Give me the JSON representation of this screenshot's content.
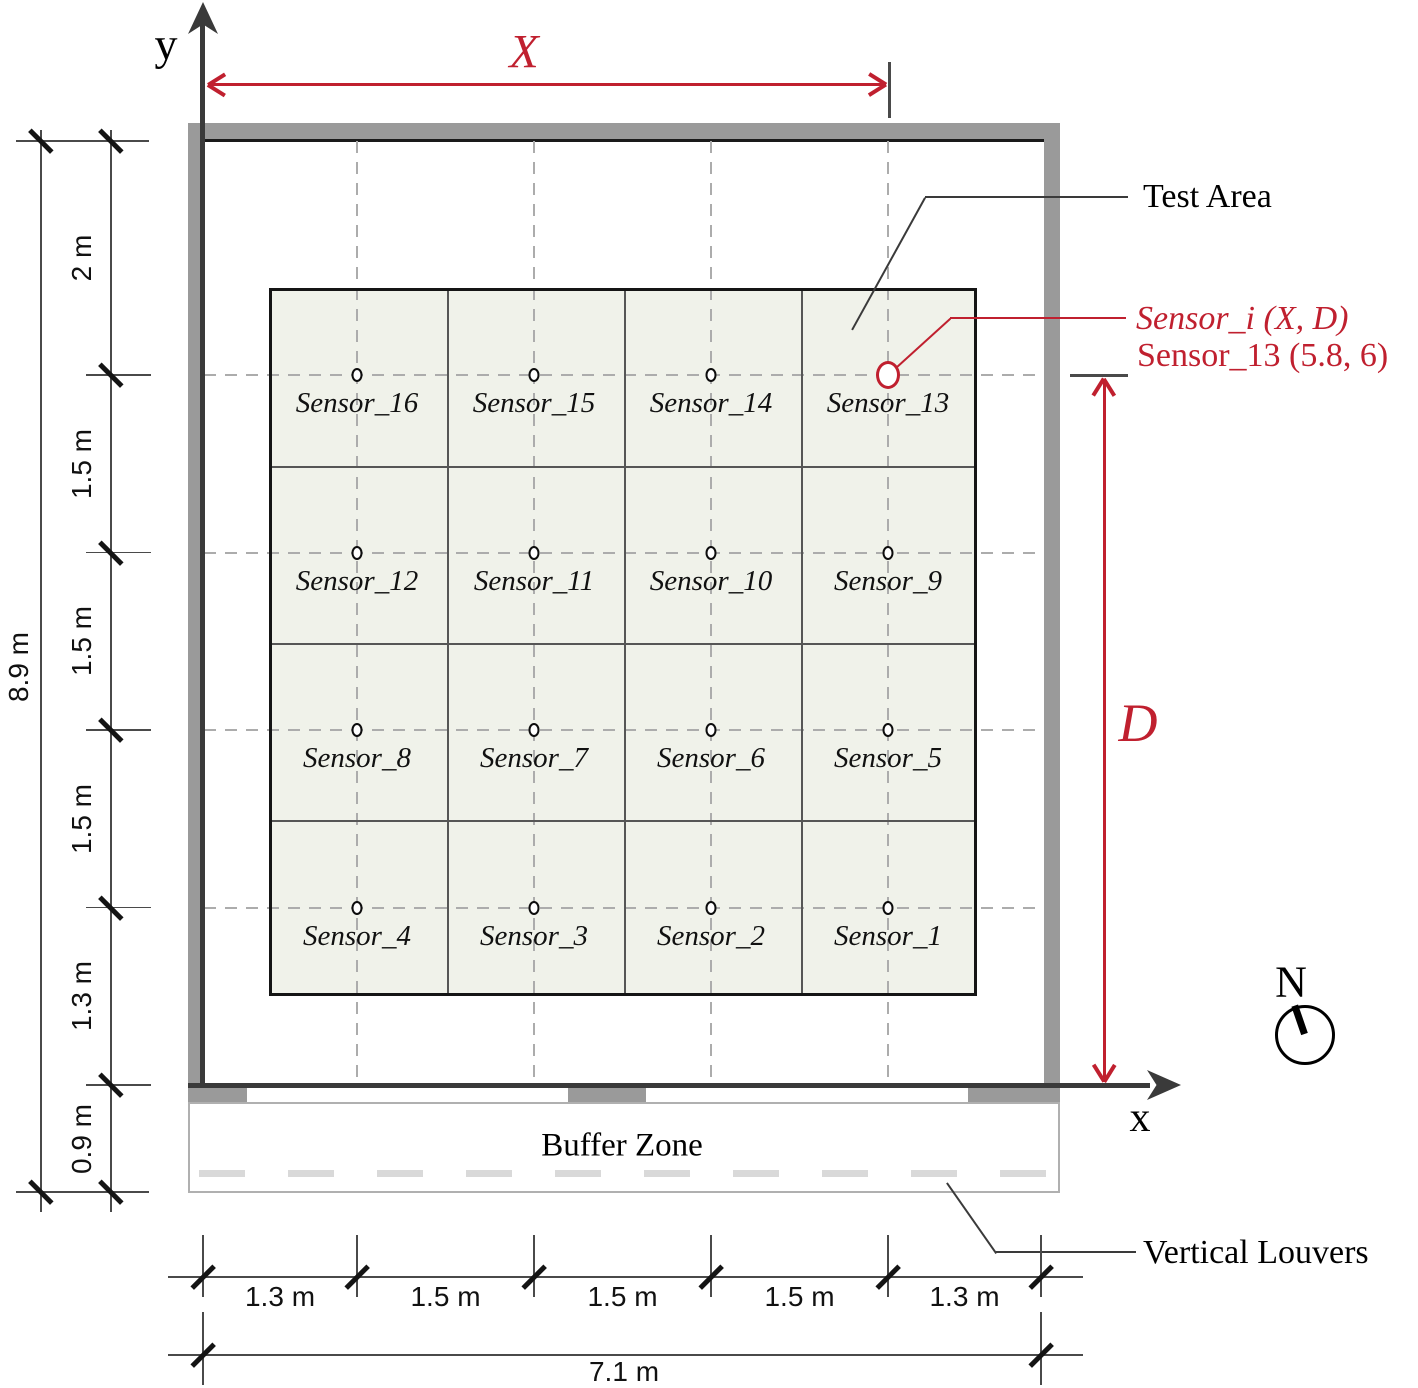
{
  "axes": {
    "x_label": "x",
    "y_label": "y"
  },
  "dimensions": {
    "top_span_label": "X",
    "right_span_label": "D",
    "left_chain": [
      "2 m",
      "1.5 m",
      "1.5 m",
      "1.5 m",
      "1.3 m",
      "0.9 m"
    ],
    "left_total": "8.9 m",
    "bottom_chain": [
      "1.3 m",
      "1.5 m",
      "1.5 m",
      "1.5 m",
      "1.3 m"
    ],
    "bottom_total": "7.1 m"
  },
  "annotations": {
    "test_area": "Test Area",
    "sensor_generic": "Sensor_i (X, D)",
    "sensor_highlight": "Sensor_13 (5.8, 6)",
    "buffer_zone": "Buffer Zone",
    "vertical_louvers": "Vertical Louvers",
    "north": "N"
  },
  "sensors": {
    "grid_rows": [
      [
        "Sensor_16",
        "Sensor_15",
        "Sensor_14",
        "Sensor_13"
      ],
      [
        "Sensor_12",
        "Sensor_11",
        "Sensor_10",
        "Sensor_9"
      ],
      [
        "Sensor_8",
        "Sensor_7",
        "Sensor_6",
        "Sensor_5"
      ],
      [
        "Sensor_4",
        "Sensor_3",
        "Sensor_2",
        "Sensor_1"
      ]
    ],
    "highlighted": "Sensor_13"
  },
  "colors": {
    "accent_red": "#c0202f",
    "wall_gray": "#9a9a9a",
    "test_area_fill": "#f0f2ea",
    "grid_dash": "#acacac",
    "louver_gray": "#d9d9d9"
  }
}
